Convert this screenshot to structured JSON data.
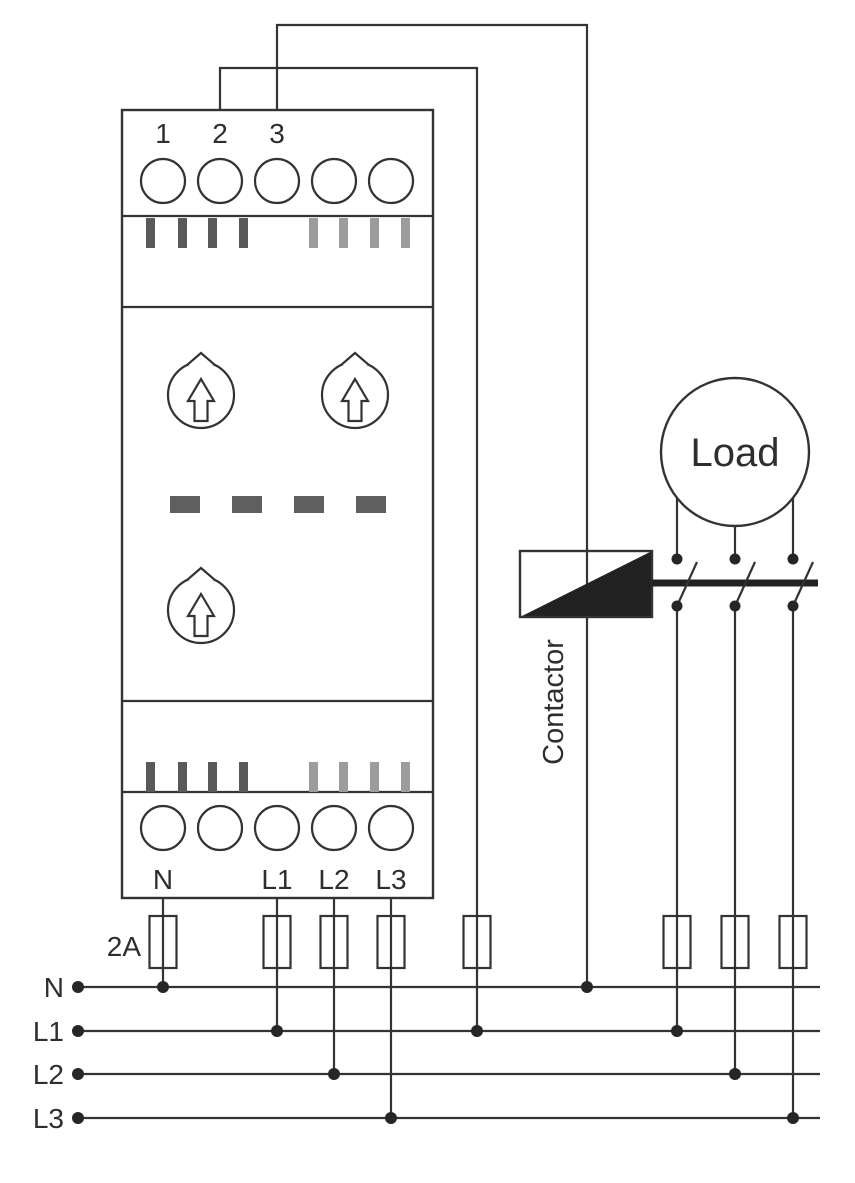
{
  "device": {
    "top_terminals": [
      "1",
      "2",
      "3"
    ],
    "bottom_terminals": [
      "N",
      "L1",
      "L2",
      "L3"
    ]
  },
  "contactor": {
    "label": "Contactor"
  },
  "load": {
    "label": "Load"
  },
  "fuses": {
    "rating_label": "2A"
  },
  "rails": {
    "labels": [
      "N",
      "L1",
      "L2",
      "L3"
    ]
  },
  "colors": {
    "line": "#333333",
    "bar_dark": "#595959",
    "bar_light": "#9c9c9c",
    "dash": "#5f5f5f",
    "solid_black": "#222222",
    "background": "#ffffff"
  }
}
